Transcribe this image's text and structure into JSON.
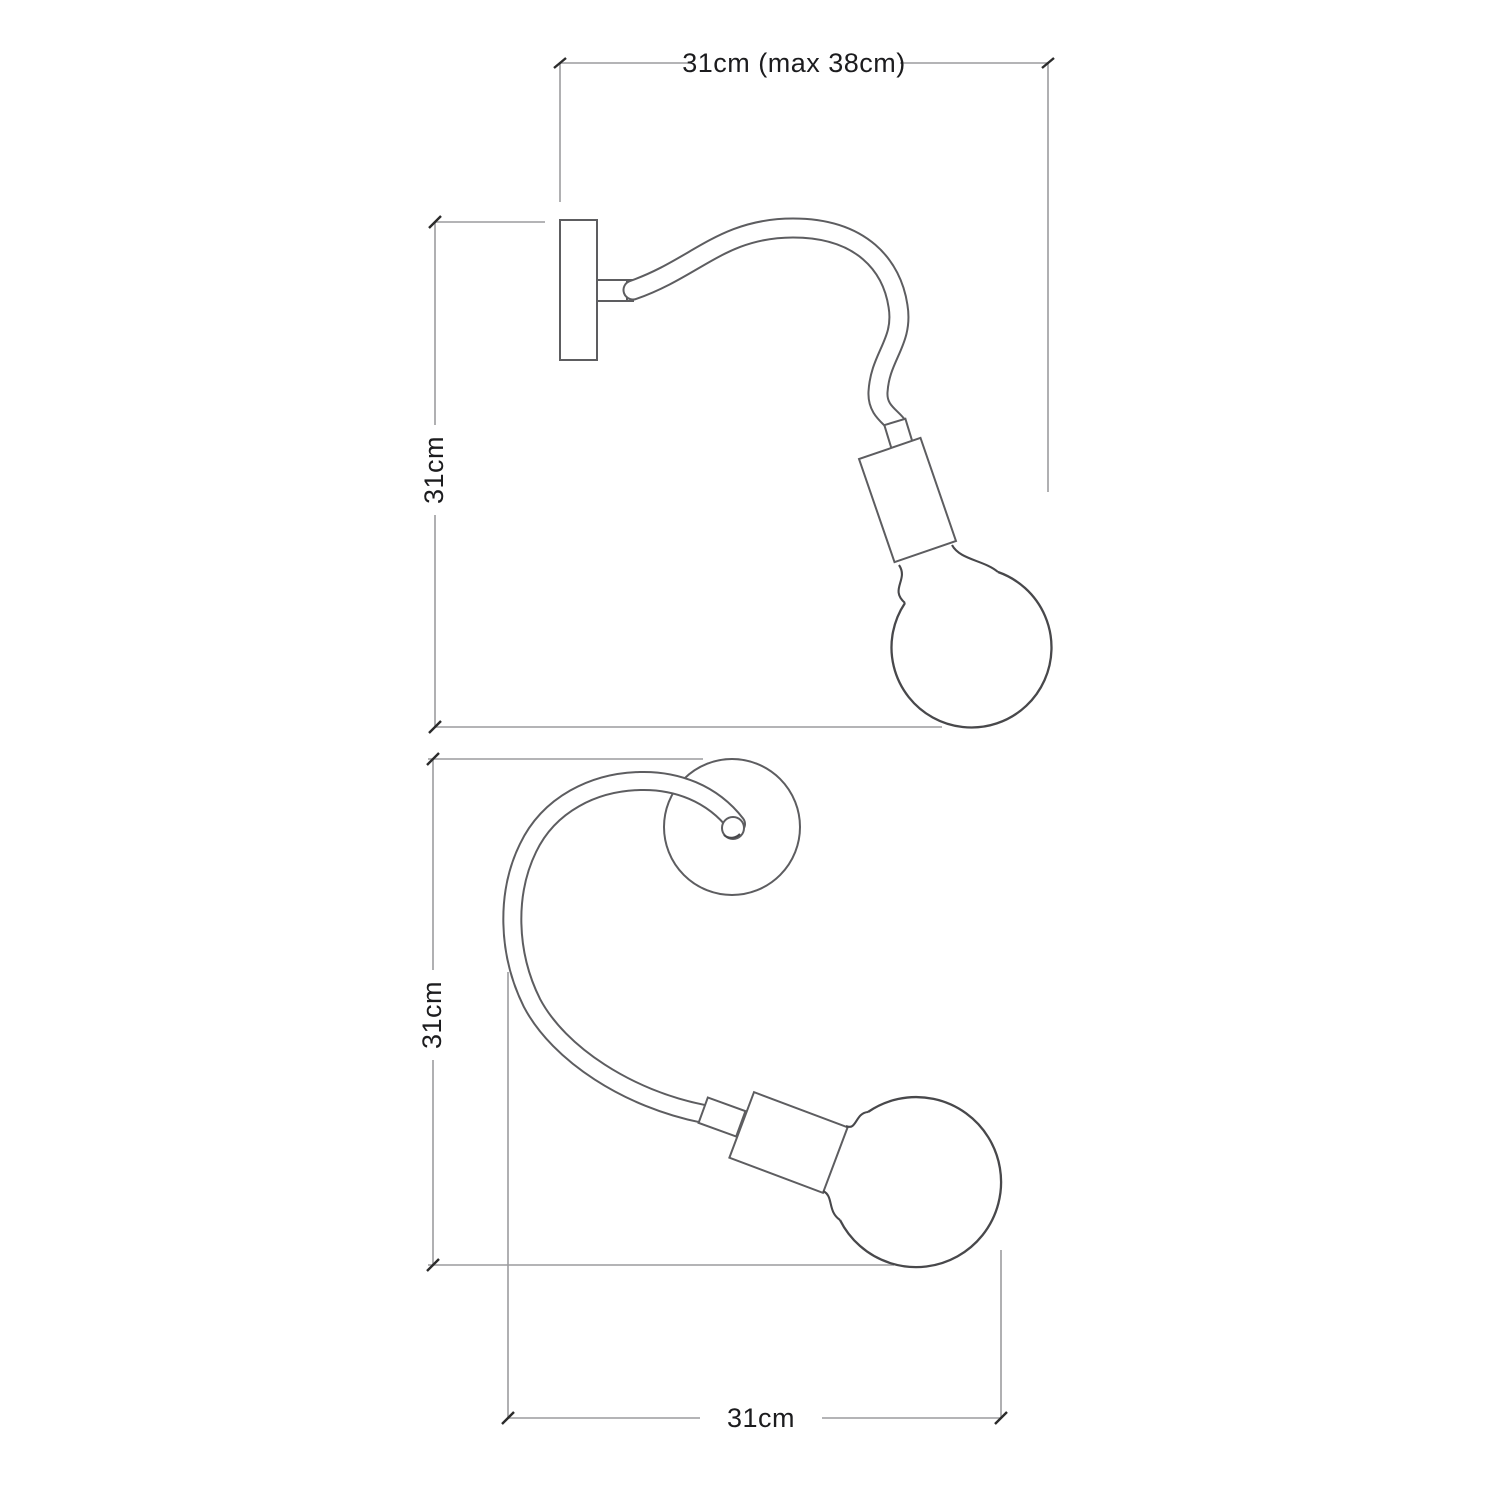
{
  "diagram": {
    "type": "technical-dimension-drawing",
    "subject": "flexible gooseneck wall lamp with bulb, two orthographic views",
    "colors": {
      "background": "#ffffff",
      "drawing_line": "#5d5d60",
      "bulb_line": "#48484b",
      "dimension_line": "#9c9c9e",
      "tick": "#2b2b2b",
      "text": "#1c1c1e"
    },
    "side_view": {
      "width_label": "31cm (max 38cm)",
      "height_label": "31cm"
    },
    "top_view": {
      "height_label": "31cm",
      "width_label": "31cm"
    }
  }
}
